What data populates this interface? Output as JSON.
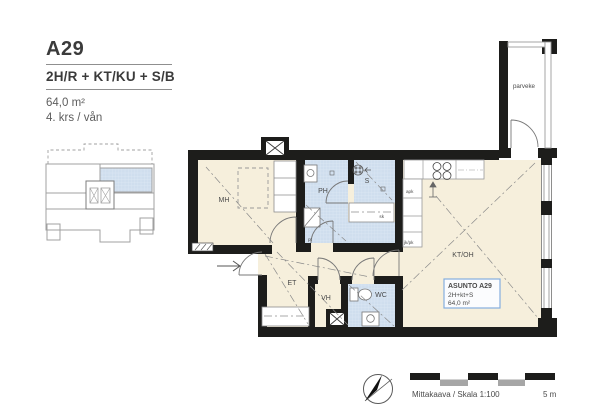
{
  "header": {
    "unit_id": "A29",
    "unit_type": "2H/R + KT/KU + S/B",
    "area": "64,0 m²",
    "floor": "4. krs / vån"
  },
  "plan": {
    "rooms": {
      "mh": "MH",
      "ph": "PH",
      "s": "S",
      "kt_oh": "KT/OH",
      "et": "ET",
      "vh": "VH",
      "wc": "WC",
      "parveke": "parveke"
    },
    "fixtures": {
      "pt": "pt",
      "sk": "sk",
      "apk": "apk",
      "jk_pk": "jk/pk"
    },
    "info_box": {
      "title": "ASUNTO A29",
      "type": "2H+kt+S",
      "area": "64,0 m²"
    }
  },
  "footer": {
    "scale_label": "Mittakaava / Skala 1:100",
    "scale_max": "5 m"
  },
  "colors": {
    "wall": "#1d1d1b",
    "floor": "#f6efdc",
    "wet_room": "#cfdeee",
    "accent_blue": "#4186cc",
    "line_gray": "#9b9b9b"
  }
}
